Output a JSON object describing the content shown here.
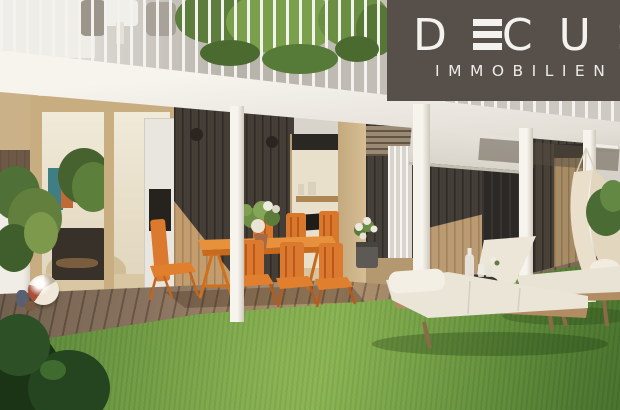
{
  "logo": {
    "brand": "DECUS",
    "subtitle": "IMMOBILIEN",
    "background_color": "#57504a",
    "text_color": "#f4f2ef"
  },
  "palette": {
    "grass": "#6a9544",
    "deck": "#8a7460",
    "dark_cladding": "#443e38",
    "light_wood_frame": "#c8ad81",
    "orange_furniture": "#db7a2e",
    "fascia_concrete": "#f2efe8",
    "lounger_cushion": "#ebe5d7"
  },
  "scene": {
    "description": "Architectural rendering of a modern apartment garden terrace: upper balcony with white railing and trailing plants, white concrete slab, ground floor with dark timber cladding and glass sliding doors, wooden deck with orange outdoor dining set, lawn with two wooden sun loungers, black side table, hammock, beach ball and hanging plants.",
    "elements": [
      "upper-balcony-railing",
      "balcony-plants",
      "concrete-fascia",
      "sliding-glass-doors",
      "dark-timber-cladding",
      "awning-screen",
      "structural-posts",
      "wooden-deck",
      "lawn",
      "orange-dining-set",
      "sun-loungers",
      "side-table",
      "hammock",
      "beach-ball",
      "hanging-plant",
      "shrub"
    ]
  }
}
